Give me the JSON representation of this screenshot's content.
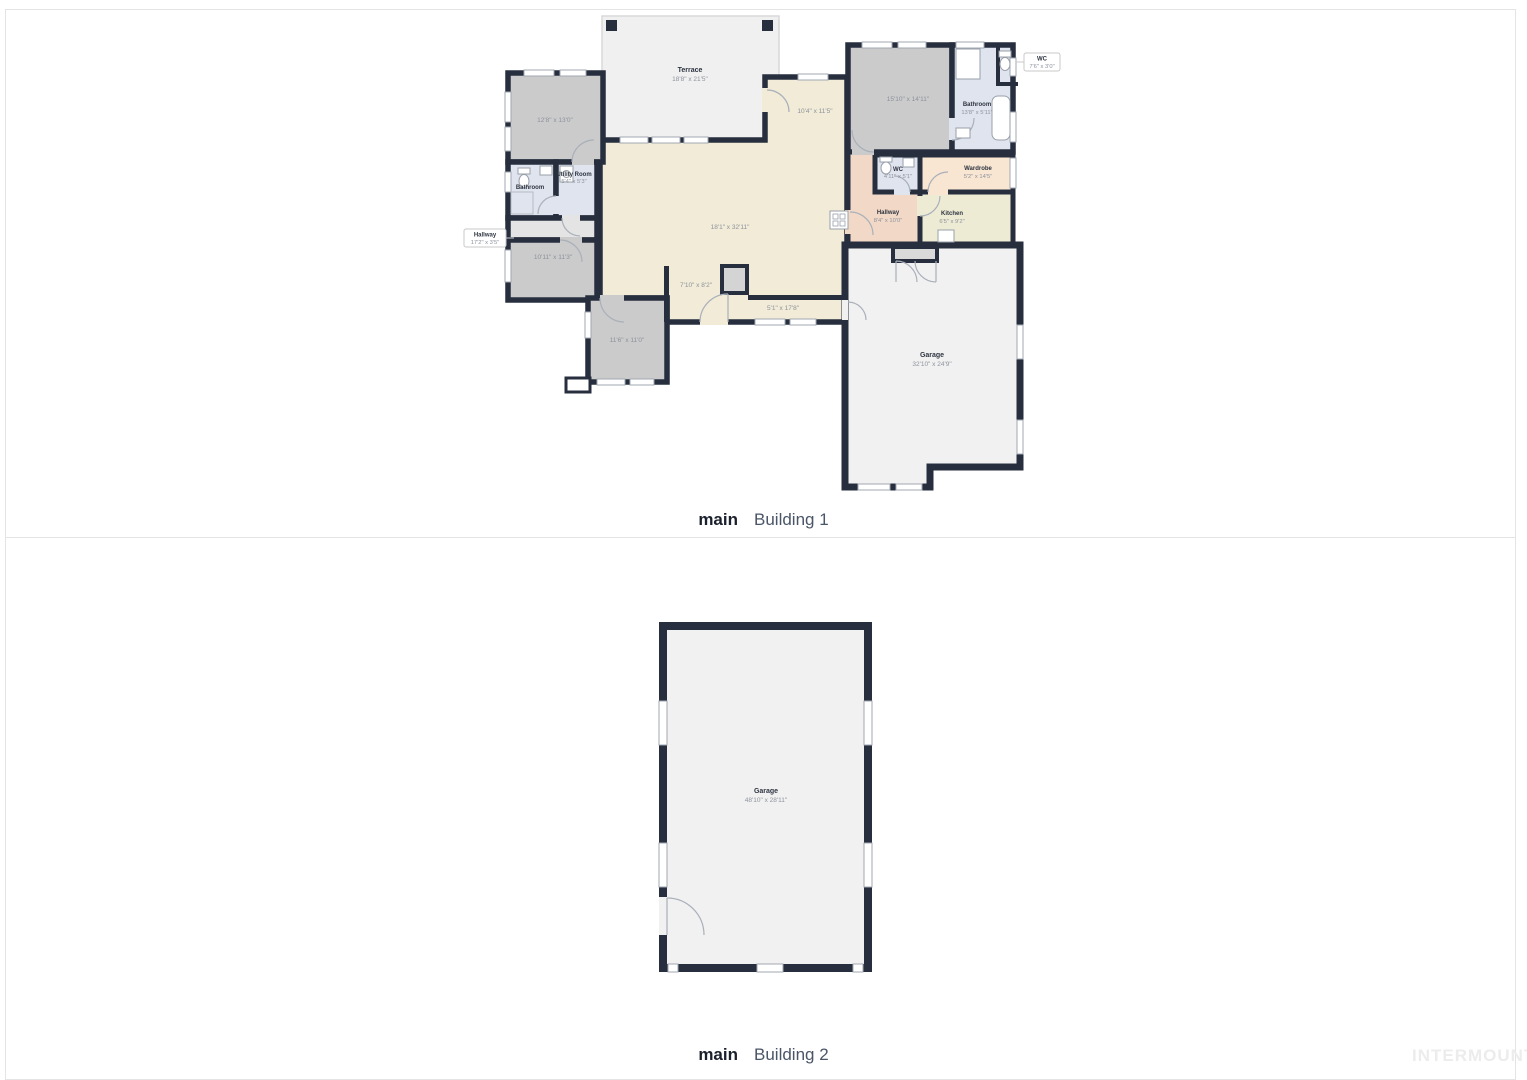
{
  "page": {
    "watermark": "INTERMOUNTAIN"
  },
  "colors": {
    "wall": "#272e3e",
    "room_grey": "#cbcbcb",
    "floor_beige": "#f1ebd7",
    "bath_blue": "#dfe4ee",
    "hall_salmon": "#f2d8c6",
    "wardrobe_peach": "#f8e5d2",
    "kitchen_cream": "#eeebd5",
    "garage_grey": "#f1f1f1"
  },
  "panels": {
    "building1": {
      "caption_prefix": "main",
      "caption_title": "Building 1",
      "rooms": {
        "terrace": {
          "name": "Terrace",
          "dims": "18'8\" x 21'5\""
        },
        "bedroom_tl": {
          "dims": "12'8\" x 13'0\""
        },
        "bathroom_left": {
          "name": "Bathroom"
        },
        "utility": {
          "name": "Utility Room",
          "dims": "5'4\" x 5'3\""
        },
        "hallway_callout": {
          "name": "Hallway",
          "dims": "17'2\" x 3'5\""
        },
        "bedroom_ml": {
          "dims": "10'11\" x 11'3\""
        },
        "bedroom_bl": {
          "dims": "11'6\" x 11'0\""
        },
        "living": {
          "dims": "18'1\" x 32'11\""
        },
        "nook": {
          "dims": "10'4\" x 11'5\""
        },
        "vestibule": {
          "dims": "7'10\" x 8'2\""
        },
        "mudroom": {
          "dims": "5'1\" x 17'8\""
        },
        "bedroom_tr": {
          "dims": "15'10\" x 14'11\""
        },
        "bathroom_tr": {
          "name": "Bathroom",
          "dims": "13'8\" x 5'11\""
        },
        "wc_callout": {
          "name": "WC",
          "dims": "7'6\" x 3'0\""
        },
        "wc": {
          "name": "WC",
          "dims": "4'11\" x 5'1\""
        },
        "wardrobe": {
          "name": "Wardrobe",
          "dims": "5'2\" x 14'5\""
        },
        "hallway": {
          "name": "Hallway",
          "dims": "8'4\" x 10'0\""
        },
        "kitchen": {
          "name": "Kitchen",
          "dims": "6'5\" x 9'2\""
        },
        "garage": {
          "name": "Garage",
          "dims": "32'10\" x 24'9\""
        }
      }
    },
    "building2": {
      "caption_prefix": "main",
      "caption_title": "Building 2",
      "rooms": {
        "garage": {
          "name": "Garage",
          "dims": "48'10\" x 28'11\""
        }
      }
    }
  }
}
